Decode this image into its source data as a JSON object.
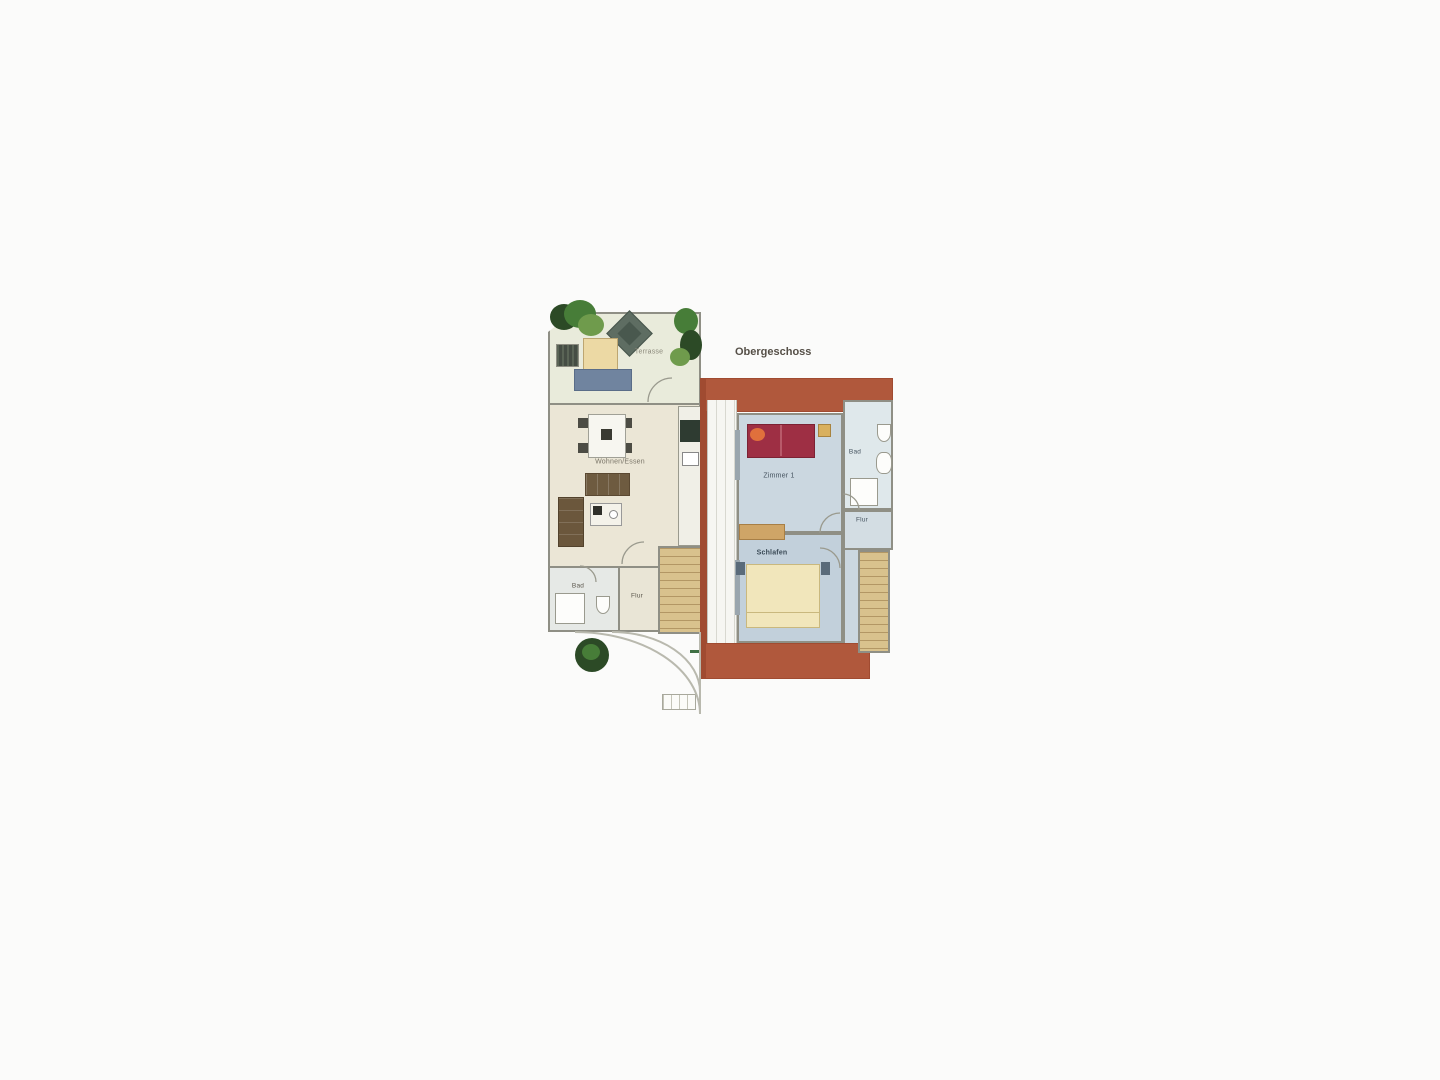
{
  "upper_floor": {
    "title": "Obergeschoss",
    "rooms": {
      "room1": "Zimmer 1",
      "bath": "Bad",
      "hall": "Flur",
      "bedroom": "Schlafen"
    }
  },
  "ground_floor": {
    "rooms": {
      "terrace": "Terrasse",
      "living": "Wohnen/Essen",
      "bath": "Bad",
      "hall": "Flur"
    }
  },
  "colors": {
    "terracotta": "#b0583c",
    "terracotta_dark": "#a04b31",
    "wall_gray": "#8f8f85",
    "floor_beige": "#ebe6d6",
    "terrace_green": "#e9ebdb",
    "room_blue": "#cbd7e0",
    "room_blue_dark": "#c2d0db",
    "bath_blue": "#dfe8eb",
    "stair_tan": "#d9c28d",
    "stair_line": "#b39764",
    "bed_red": "#9e2f44",
    "pillow_orange": "#e0703c",
    "bed_cream": "#f1e6bb",
    "wood_brown": "#6e5b40",
    "wood_brown_dark": "#5a4831",
    "counter_dark": "#2e3b31",
    "plant_dark": "#2c4a26",
    "plant_mid": "#477d38",
    "plant_light": "#6f9b4c",
    "lounger_blue": "#70849f",
    "sand": "#ecd9a4",
    "sideboard_tan": "#cfa567",
    "label_color": "#5a564c"
  }
}
